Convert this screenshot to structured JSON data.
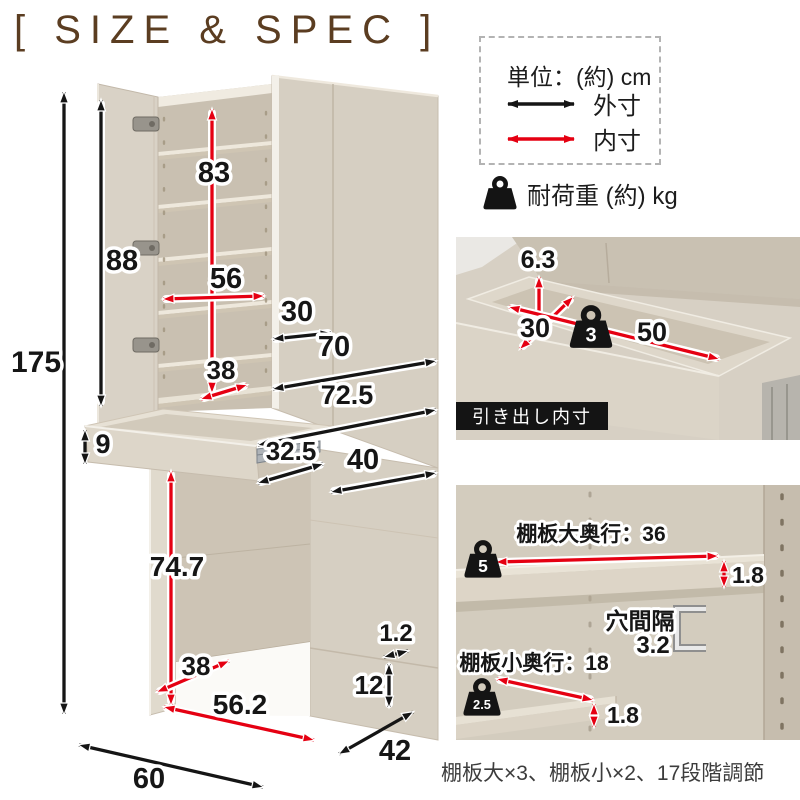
{
  "title": "[ SIZE & SPEC ]",
  "legend": {
    "unit": "単位：(約) cm",
    "outer": "外寸",
    "inner": "内寸",
    "load": "耐荷重 (約) kg",
    "outer_color": "#151515",
    "inner_color": "#e50012"
  },
  "main": {
    "dims": {
      "total_height": "175",
      "door_height": "88",
      "upper_inner_height": "83",
      "upper_inner_width": "56",
      "door_width": "30",
      "upper_shelf_depth": "38",
      "upper_front_width": "70",
      "upper_total_width": "72.5",
      "drawer_front_height": "9",
      "drawer_depth": "32.5",
      "upper_side_depth": "40",
      "knee_height": "74.7",
      "knee_depth": "38",
      "knee_width": "56.2",
      "panel_thickness": "1.2",
      "base_height": "12",
      "total_depth": "42",
      "base_width": "60"
    }
  },
  "drawer_panel": {
    "caption": "引き出し内寸",
    "inner_height": "6.3",
    "inner_depth": "30",
    "inner_width": "50",
    "load": "3"
  },
  "shelf_panel": {
    "large_label": "棚板大奥行：36",
    "large_load": "5",
    "large_thickness": "1.8",
    "hole_label": "穴間隔",
    "hole_pitch": "3.2",
    "small_label": "棚板小奥行：18",
    "small_load": "2.5",
    "small_thickness": "1.8"
  },
  "footnote": "棚板大×3、棚板小×2、17段階調節"
}
